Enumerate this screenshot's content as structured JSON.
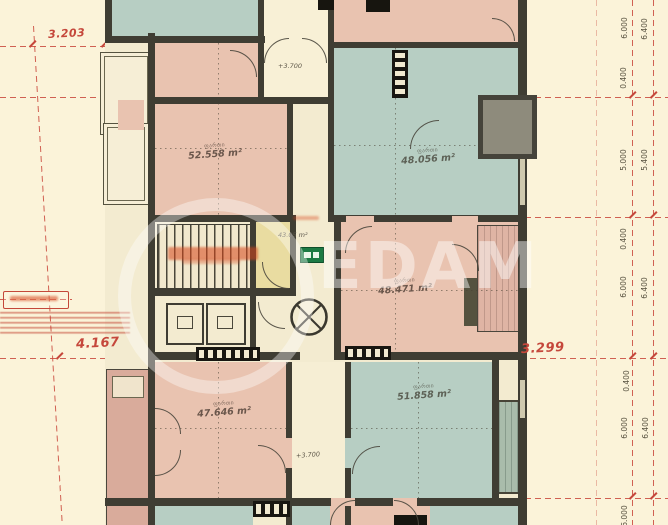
{
  "watermark": {
    "text": "EDAM"
  },
  "rooms": [
    {
      "name": "ფართი",
      "area": "52.558 m²"
    },
    {
      "name": "ფართი",
      "area": "48.056 m²"
    },
    {
      "name": "ფართი",
      "area": "48.471 m²"
    },
    {
      "name": "ფართი",
      "area": "47.646 m²"
    },
    {
      "name": "ფართი",
      "area": "51.858 m²"
    }
  ],
  "corridor": {
    "area": "43.05 m²"
  },
  "levels": {
    "upper": "+3.700",
    "lower": "+3.700"
  },
  "red_dims": {
    "top_left": "3.203",
    "mid_left": "4.167",
    "mid_right": "3.299"
  },
  "chain_inner": [
    "6.000",
    "0.400",
    "5.000",
    "0.400",
    "6.000",
    "0.400",
    "6.000",
    "6.000"
  ],
  "chain_outer": [
    "6.400",
    "5.400",
    "6.400",
    "6.400"
  ],
  "colors": {
    "pink": "#e9c3b0",
    "teal": "#b7cec3",
    "yellow": "#e9dca1",
    "mauve": "#d9ab9b",
    "wall": "#3f3d33",
    "red": "#c9463a",
    "bg": "#fbf3d9",
    "exit_green": "#1c7a44"
  }
}
